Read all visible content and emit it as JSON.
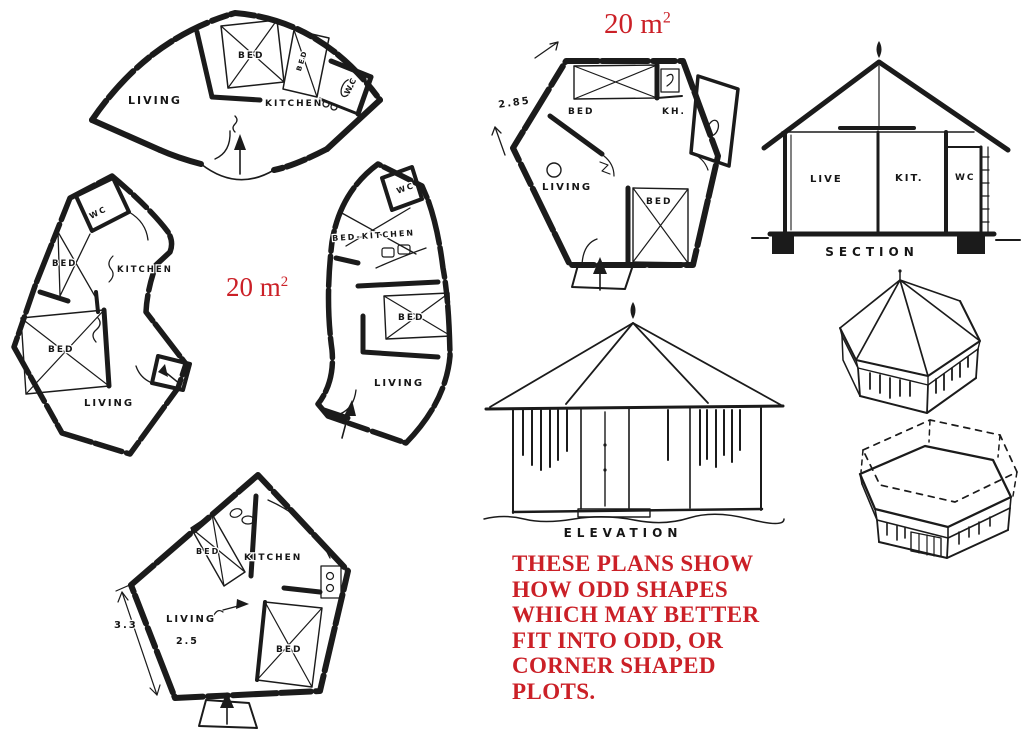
{
  "page": {
    "background": "#ffffff",
    "ink": "#1b1b1b",
    "red": "#cb2027"
  },
  "areas": {
    "left": {
      "base": "20 m",
      "sup": "2"
    },
    "top": {
      "base": "20 m",
      "sup": "2"
    }
  },
  "plans": {
    "fan": {
      "living": "LIVING",
      "bed": "BED",
      "bed2": "BED",
      "kitchen": "KITCHEN",
      "wc": "WC"
    },
    "boot": {
      "wc": "WC",
      "bed": "BED",
      "kitchen": "KITCHEN",
      "bed2": "BED",
      "living": "LIVING"
    },
    "curve": {
      "wc": "WC",
      "bed_kitchen": "BED-KITCHEN",
      "bed": "BED",
      "living": "LIVING"
    },
    "pentagon": {
      "bed": "BED",
      "kitchen": "KITCHEN",
      "living": "LIVING",
      "bed2": "BED",
      "dim_side": "3.3",
      "dim_width": "2.5"
    },
    "hexagon": {
      "bed": "BED",
      "kitchen": "KH.",
      "living": "LIVING",
      "bed2": "BED",
      "dim_side": "2.85"
    }
  },
  "section": {
    "live": "LIVE",
    "kit": "KIT.",
    "wc": "WC",
    "caption": "SECTION"
  },
  "elevation": {
    "caption": "ELEVATION"
  },
  "note": {
    "lines": [
      "THESE PLANS SHOW",
      "HOW ODD SHAPES",
      "WHICH MAY BETTER",
      "FIT INTO ODD, OR",
      "CORNER SHAPED",
      "PLOTS."
    ]
  }
}
